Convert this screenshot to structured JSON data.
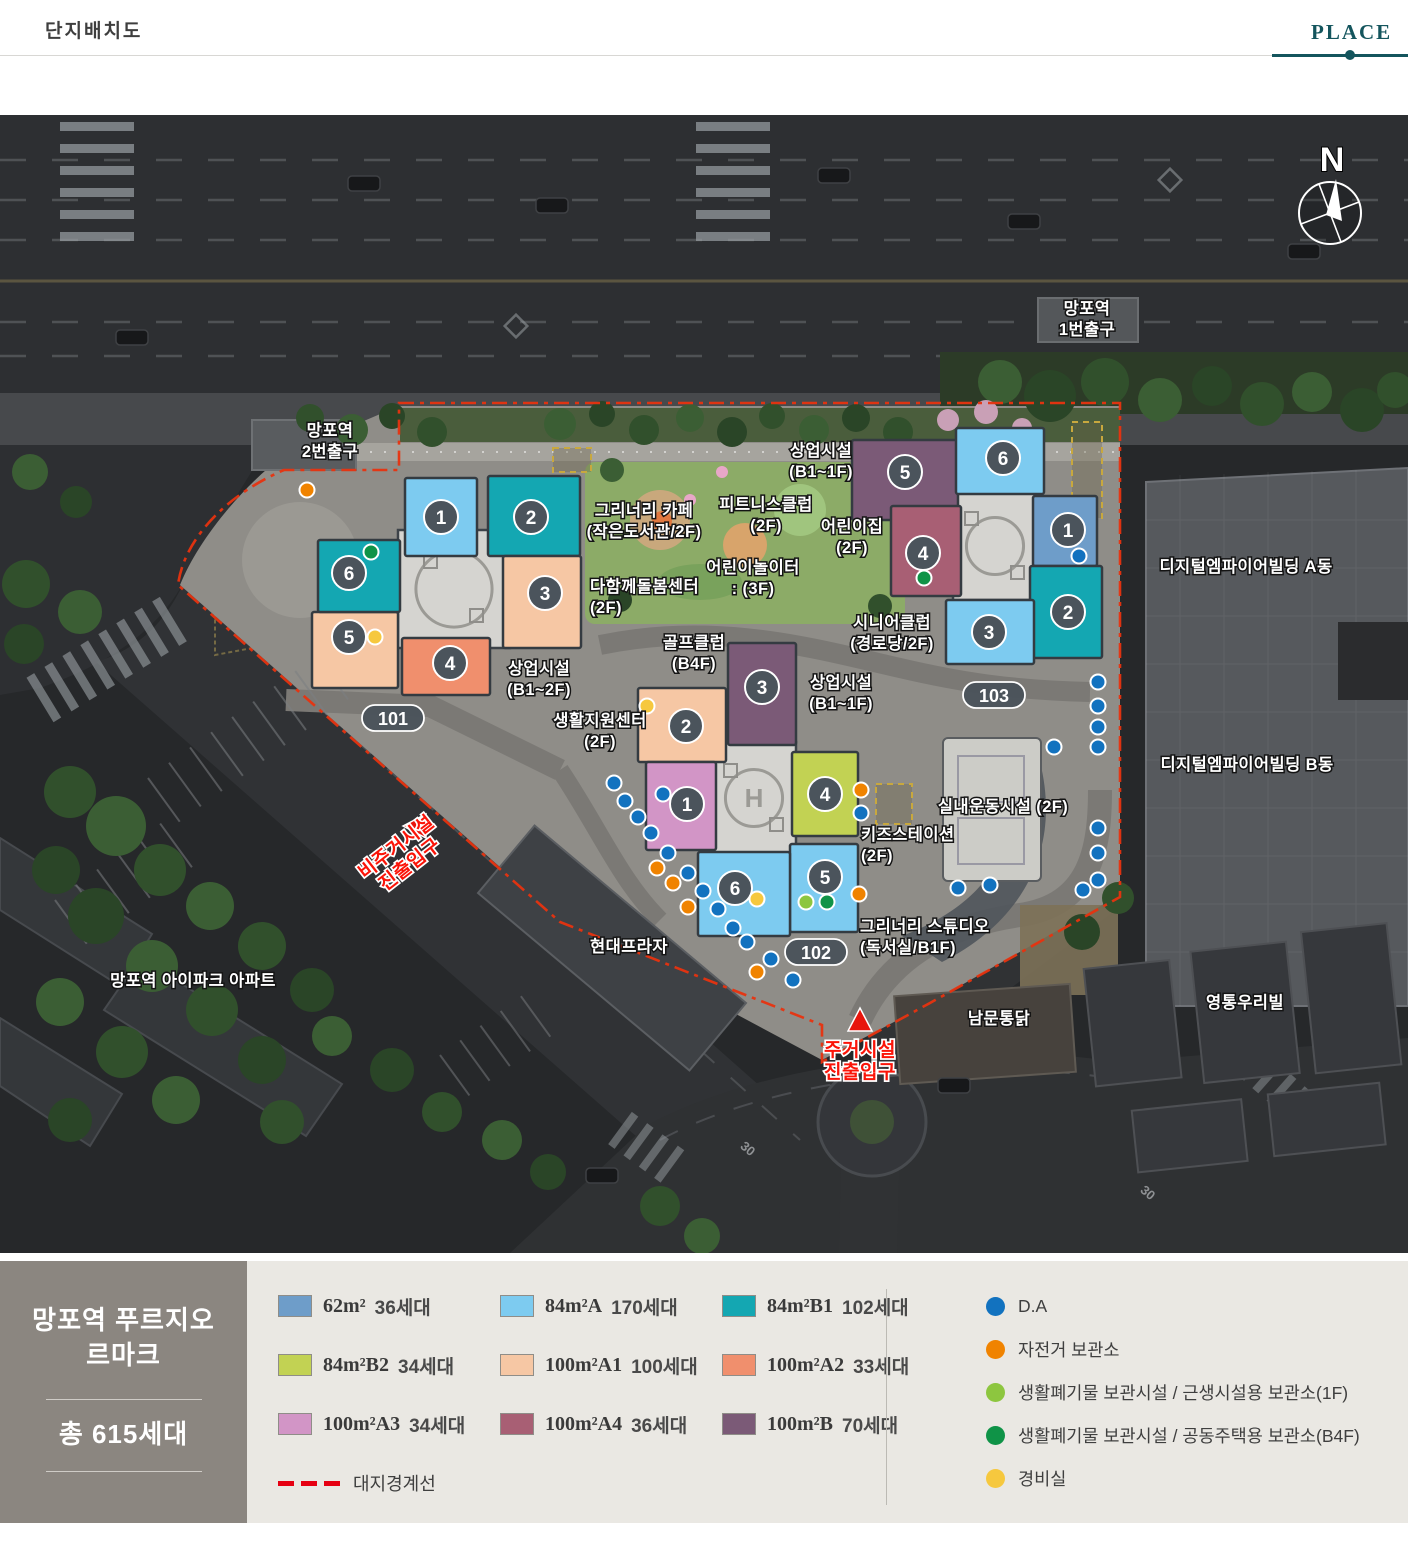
{
  "header": {
    "title": "단지배치도",
    "tab_label": "PLACE"
  },
  "project": {
    "name_line1": "망포역 푸르지오",
    "name_line2": "르마크",
    "total_label": "총 615세대"
  },
  "colors": {
    "accent_teal": "#14555d",
    "boundary_red": "#e8330f",
    "dot_colors": {
      "b": "#1272bf",
      "o": "#f08300",
      "lg": "#8dc63f",
      "dg": "#0f9347",
      "y": "#f6c83e"
    }
  },
  "legend": {
    "unit_types": [
      {
        "size": "62m²",
        "count": "36세대",
        "color": "#6e9dc9"
      },
      {
        "size": "84m²A",
        "count": "170세대",
        "color": "#7dcbf0"
      },
      {
        "size": "84m²B1",
        "count": "102세대",
        "color": "#14a7b2"
      },
      {
        "size": "84m²B2",
        "count": "34세대",
        "color": "#c2d253"
      },
      {
        "size": "100m²A1",
        "count": "100세대",
        "color": "#f6c7a4"
      },
      {
        "size": "100m²A2",
        "count": "33세대",
        "color": "#f08f6d"
      },
      {
        "size": "100m²A3",
        "count": "34세대",
        "color": "#d295c6"
      },
      {
        "size": "100m²A4",
        "count": "36세대",
        "color": "#a85f74"
      },
      {
        "size": "100m²B",
        "count": "70세대",
        "color": "#7b5a77"
      }
    ],
    "boundary_label": "대지경계선",
    "markers": [
      {
        "key": "b",
        "label": "D.A"
      },
      {
        "key": "o",
        "label": "자전거 보관소"
      },
      {
        "key": "lg",
        "label": "생활폐기물 보관시설 / 근생시설용 보관소(1F)"
      },
      {
        "key": "dg",
        "label": "생활폐기물 보관시설 / 공동주택용 보관소(B4F)"
      },
      {
        "key": "y",
        "label": "경비실"
      }
    ]
  },
  "map": {
    "compass_label": "N",
    "badges": [
      {
        "label": "101",
        "x": 393,
        "y": 719
      },
      {
        "label": "102",
        "x": 816,
        "y": 953
      },
      {
        "label": "103",
        "x": 994,
        "y": 696
      }
    ],
    "clusters": [
      {
        "name": "101",
        "core": {
          "x": 398,
          "y": 530,
          "w": 112,
          "h": 118
        },
        "has_h": false,
        "units": [
          {
            "no": "1",
            "type": "84m²A",
            "x": 405,
            "y": 478,
            "w": 72,
            "h": 78,
            "cx": 441,
            "cy": 517
          },
          {
            "no": "2",
            "type": "84m²B1",
            "x": 488,
            "y": 476,
            "w": 92,
            "h": 80,
            "cx": 531,
            "cy": 517
          },
          {
            "no": "3",
            "type": "100m²A1",
            "x": 503,
            "y": 556,
            "w": 78,
            "h": 92,
            "cx": 545,
            "cy": 593
          },
          {
            "no": "4",
            "type": "100m²A2",
            "x": 402,
            "y": 638,
            "w": 88,
            "h": 57,
            "cx": 450,
            "cy": 663
          },
          {
            "no": "5",
            "type": "100m²A1",
            "x": 312,
            "y": 612,
            "w": 86,
            "h": 76,
            "cx": 349,
            "cy": 637
          },
          {
            "no": "6",
            "type": "84m²B1",
            "x": 318,
            "y": 540,
            "w": 82,
            "h": 72,
            "cx": 349,
            "cy": 573
          }
        ]
      },
      {
        "name": "102",
        "core": {
          "x": 712,
          "y": 742,
          "w": 84,
          "h": 112
        },
        "has_h": true,
        "units": [
          {
            "no": "3",
            "type": "100m²B",
            "x": 728,
            "y": 643,
            "w": 68,
            "h": 102,
            "cx": 762,
            "cy": 687
          },
          {
            "no": "2",
            "type": "100m²A1",
            "x": 638,
            "y": 688,
            "w": 88,
            "h": 74,
            "cx": 686,
            "cy": 726
          },
          {
            "no": "1",
            "type": "100m²A3",
            "x": 646,
            "y": 762,
            "w": 70,
            "h": 88,
            "cx": 687,
            "cy": 804
          },
          {
            "no": "4",
            "type": "84m²B2",
            "x": 792,
            "y": 752,
            "w": 66,
            "h": 84,
            "cx": 825,
            "cy": 794
          },
          {
            "no": "5",
            "type": "84m²A",
            "x": 790,
            "y": 844,
            "w": 68,
            "h": 88,
            "cx": 825,
            "cy": 877
          },
          {
            "no": "6",
            "type": "84m²A",
            "x": 698,
            "y": 852,
            "w": 92,
            "h": 84,
            "cx": 735,
            "cy": 888
          }
        ]
      },
      {
        "name": "103",
        "core": {
          "x": 953,
          "y": 492,
          "w": 84,
          "h": 108
        },
        "has_h": false,
        "units": [
          {
            "no": "5",
            "type": "100m²B",
            "x": 852,
            "y": 440,
            "w": 106,
            "h": 80,
            "cx": 905,
            "cy": 472
          },
          {
            "no": "6",
            "type": "84m²A",
            "x": 956,
            "y": 428,
            "w": 88,
            "h": 66,
            "cx": 1003,
            "cy": 458
          },
          {
            "no": "4",
            "type": "100m²A4",
            "x": 891,
            "y": 506,
            "w": 70,
            "h": 90,
            "cx": 923,
            "cy": 553
          },
          {
            "no": "1",
            "type": "62m²",
            "x": 1033,
            "y": 496,
            "w": 64,
            "h": 70,
            "cx": 1068,
            "cy": 530
          },
          {
            "no": "2",
            "type": "84m²B1",
            "x": 1030,
            "y": 566,
            "w": 72,
            "h": 92,
            "cx": 1068,
            "cy": 612
          },
          {
            "no": "3",
            "type": "84m²A",
            "x": 946,
            "y": 600,
            "w": 88,
            "h": 64,
            "cx": 989,
            "cy": 632
          }
        ]
      }
    ],
    "labels": [
      {
        "lines": [
          "망포역",
          "2번출구"
        ],
        "x": 330,
        "y": 436
      },
      {
        "lines": [
          "망포역",
          "1번출구"
        ],
        "x": 1087,
        "y": 314
      },
      {
        "lines": [
          "그리너리 카페",
          "(작은도서관/2F)"
        ],
        "x": 644,
        "y": 516
      },
      {
        "lines": [
          "피트니스클럽",
          "(2F)"
        ],
        "x": 766,
        "y": 510
      },
      {
        "lines": [
          "어린이집",
          "(2F)"
        ],
        "x": 852,
        "y": 532
      },
      {
        "lines": [
          "어린이놀이터",
          ": (3F)"
        ],
        "x": 753,
        "y": 573
      },
      {
        "lines": [
          "다함께돌봄센터",
          "(2F)"
        ],
        "x": 590,
        "y": 592,
        "anchor": "start"
      },
      {
        "lines": [
          "상업시설",
          "(B1~2F)"
        ],
        "x": 539,
        "y": 674
      },
      {
        "lines": [
          "골프클럽",
          "(B4F)"
        ],
        "x": 694,
        "y": 648
      },
      {
        "lines": [
          "생활지원센터",
          "(2F)"
        ],
        "x": 600,
        "y": 726
      },
      {
        "lines": [
          "상업시설",
          "(B1~1F)"
        ],
        "x": 821,
        "y": 456
      },
      {
        "lines": [
          "시니어클럽",
          "(경로당/2F)"
        ],
        "x": 892,
        "y": 628
      },
      {
        "lines": [
          "상업시설",
          "(B1~1F)"
        ],
        "x": 841,
        "y": 688
      },
      {
        "lines": [
          "키즈스테이션",
          "(2F)"
        ],
        "x": 861,
        "y": 840,
        "anchor": "start"
      },
      {
        "lines": [
          "실내운동시설 (2F)"
        ],
        "x": 1003,
        "y": 812
      },
      {
        "lines": [
          "그리너리 스튜디오",
          "(독서실/B1F)"
        ],
        "x": 860,
        "y": 932,
        "anchor": "start"
      },
      {
        "lines": [
          "현대프라자"
        ],
        "x": 629,
        "y": 952
      },
      {
        "lines": [
          "망포역 아이파크 아파트"
        ],
        "x": 193,
        "y": 986
      },
      {
        "lines": [
          "남문통닭"
        ],
        "x": 999,
        "y": 1024
      },
      {
        "lines": [
          "영통우리빌"
        ],
        "x": 1245,
        "y": 1008
      },
      {
        "lines": [
          "디지털엠파이어빌딩 A동"
        ],
        "x": 1246,
        "y": 572
      },
      {
        "lines": [
          "디지털엠파이어빌딩 B동"
        ],
        "x": 1247,
        "y": 770
      }
    ],
    "entrances": [
      {
        "lines": [
          "비주거시설",
          "진출입구"
        ],
        "x": 400,
        "y": 852,
        "rotate": -38,
        "tri_x": 417,
        "tri_y": 826,
        "tri_rotate": -90
      },
      {
        "lines": [
          "주거시설",
          "진출입구"
        ],
        "x": 860,
        "y": 1056,
        "rotate": 0,
        "tri_x": 860,
        "tri_y": 1022,
        "tri_rotate": 0
      }
    ],
    "road_markings": [
      {
        "label": "30",
        "x": 745,
        "y": 1152,
        "rotate": 40
      },
      {
        "label": "30",
        "x": 1145,
        "y": 1196,
        "rotate": 40
      }
    ],
    "dots": [
      [
        "o",
        307,
        490
      ],
      [
        "dg",
        371,
        552
      ],
      [
        "y",
        375,
        637
      ],
      [
        "dg",
        924,
        578
      ],
      [
        "b",
        1079,
        556
      ],
      [
        "y",
        647,
        706
      ],
      [
        "b",
        663,
        794
      ],
      [
        "o",
        861,
        790
      ],
      [
        "b",
        861,
        813
      ],
      [
        "o",
        859,
        894
      ],
      [
        "lg",
        806,
        902
      ],
      [
        "dg",
        827,
        902
      ],
      [
        "y",
        757,
        899
      ],
      [
        "b",
        614,
        783
      ],
      [
        "b",
        625,
        801
      ],
      [
        "b",
        638,
        817
      ],
      [
        "b",
        651,
        833
      ],
      [
        "b",
        668,
        853
      ],
      [
        "o",
        657,
        868
      ],
      [
        "o",
        673,
        883
      ],
      [
        "b",
        688,
        873
      ],
      [
        "b",
        703,
        891
      ],
      [
        "o",
        688,
        907
      ],
      [
        "b",
        718,
        909
      ],
      [
        "b",
        733,
        928
      ],
      [
        "b",
        747,
        942
      ],
      [
        "b",
        771,
        959
      ],
      [
        "o",
        757,
        972
      ],
      [
        "b",
        793,
        980
      ],
      [
        "b",
        1098,
        682
      ],
      [
        "b",
        1098,
        706
      ],
      [
        "b",
        1098,
        727
      ],
      [
        "b",
        1098,
        747
      ],
      [
        "b",
        1054,
        747
      ],
      [
        "b",
        1098,
        828
      ],
      [
        "b",
        1098,
        853
      ],
      [
        "b",
        1098,
        880
      ],
      [
        "b",
        1083,
        890
      ],
      [
        "b",
        958,
        888
      ],
      [
        "b",
        990,
        885
      ]
    ]
  }
}
